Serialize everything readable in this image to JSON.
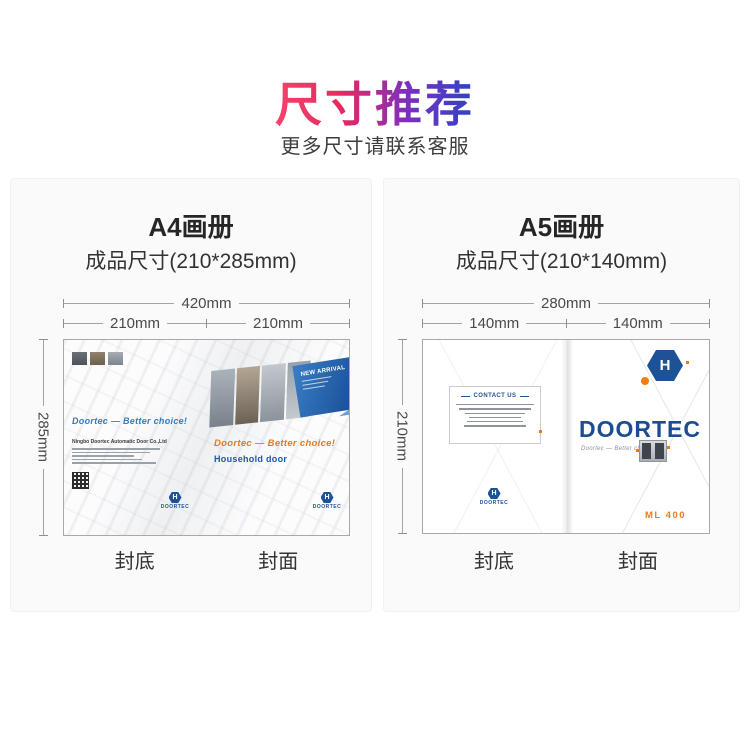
{
  "header": {
    "title": "尺寸推荐",
    "subtitle": "更多尺寸请联系客服"
  },
  "colors": {
    "title_gradient_start": "#f2446b",
    "title_gradient_mid": "#7d2fbe",
    "title_gradient_end": "#2b43c8",
    "brand_blue": "#1c4d92",
    "accent_orange": "#ef7d12"
  },
  "panels": [
    {
      "title": "A4画册",
      "size_label": "成品尺寸(210*285mm)",
      "dims": {
        "total": "420mm",
        "left": "210mm",
        "right": "210mm",
        "side": "285mm"
      },
      "cover_labels": {
        "back": "封底",
        "front": "封面"
      },
      "artwork": {
        "back_tagline": "Doortec — Better choice!",
        "company_name": "Ningbo Doortec Automatic Door Co.,Ltd",
        "back_logo_text": "DOORTEC",
        "banner_title": "NEW ARRIVAL",
        "front_tagline": "Doortec — Better choice!",
        "front_product": "Household door",
        "front_logo_text": "DOORTEC",
        "hex_letter": "H"
      }
    },
    {
      "title": "A5画册",
      "size_label": "成品尺寸(210*140mm)",
      "dims": {
        "total": "280mm",
        "left": "140mm",
        "right": "140mm",
        "side": "210mm"
      },
      "cover_labels": {
        "back": "封底",
        "front": "封面"
      },
      "artwork": {
        "contact_title": "CONTACT US",
        "back_logo_text": "DOORTEC",
        "brand": "DOORTEC",
        "front_tagline": "Doortec — Better choice",
        "model": "ML 400",
        "hex_letter": "H"
      }
    }
  ]
}
